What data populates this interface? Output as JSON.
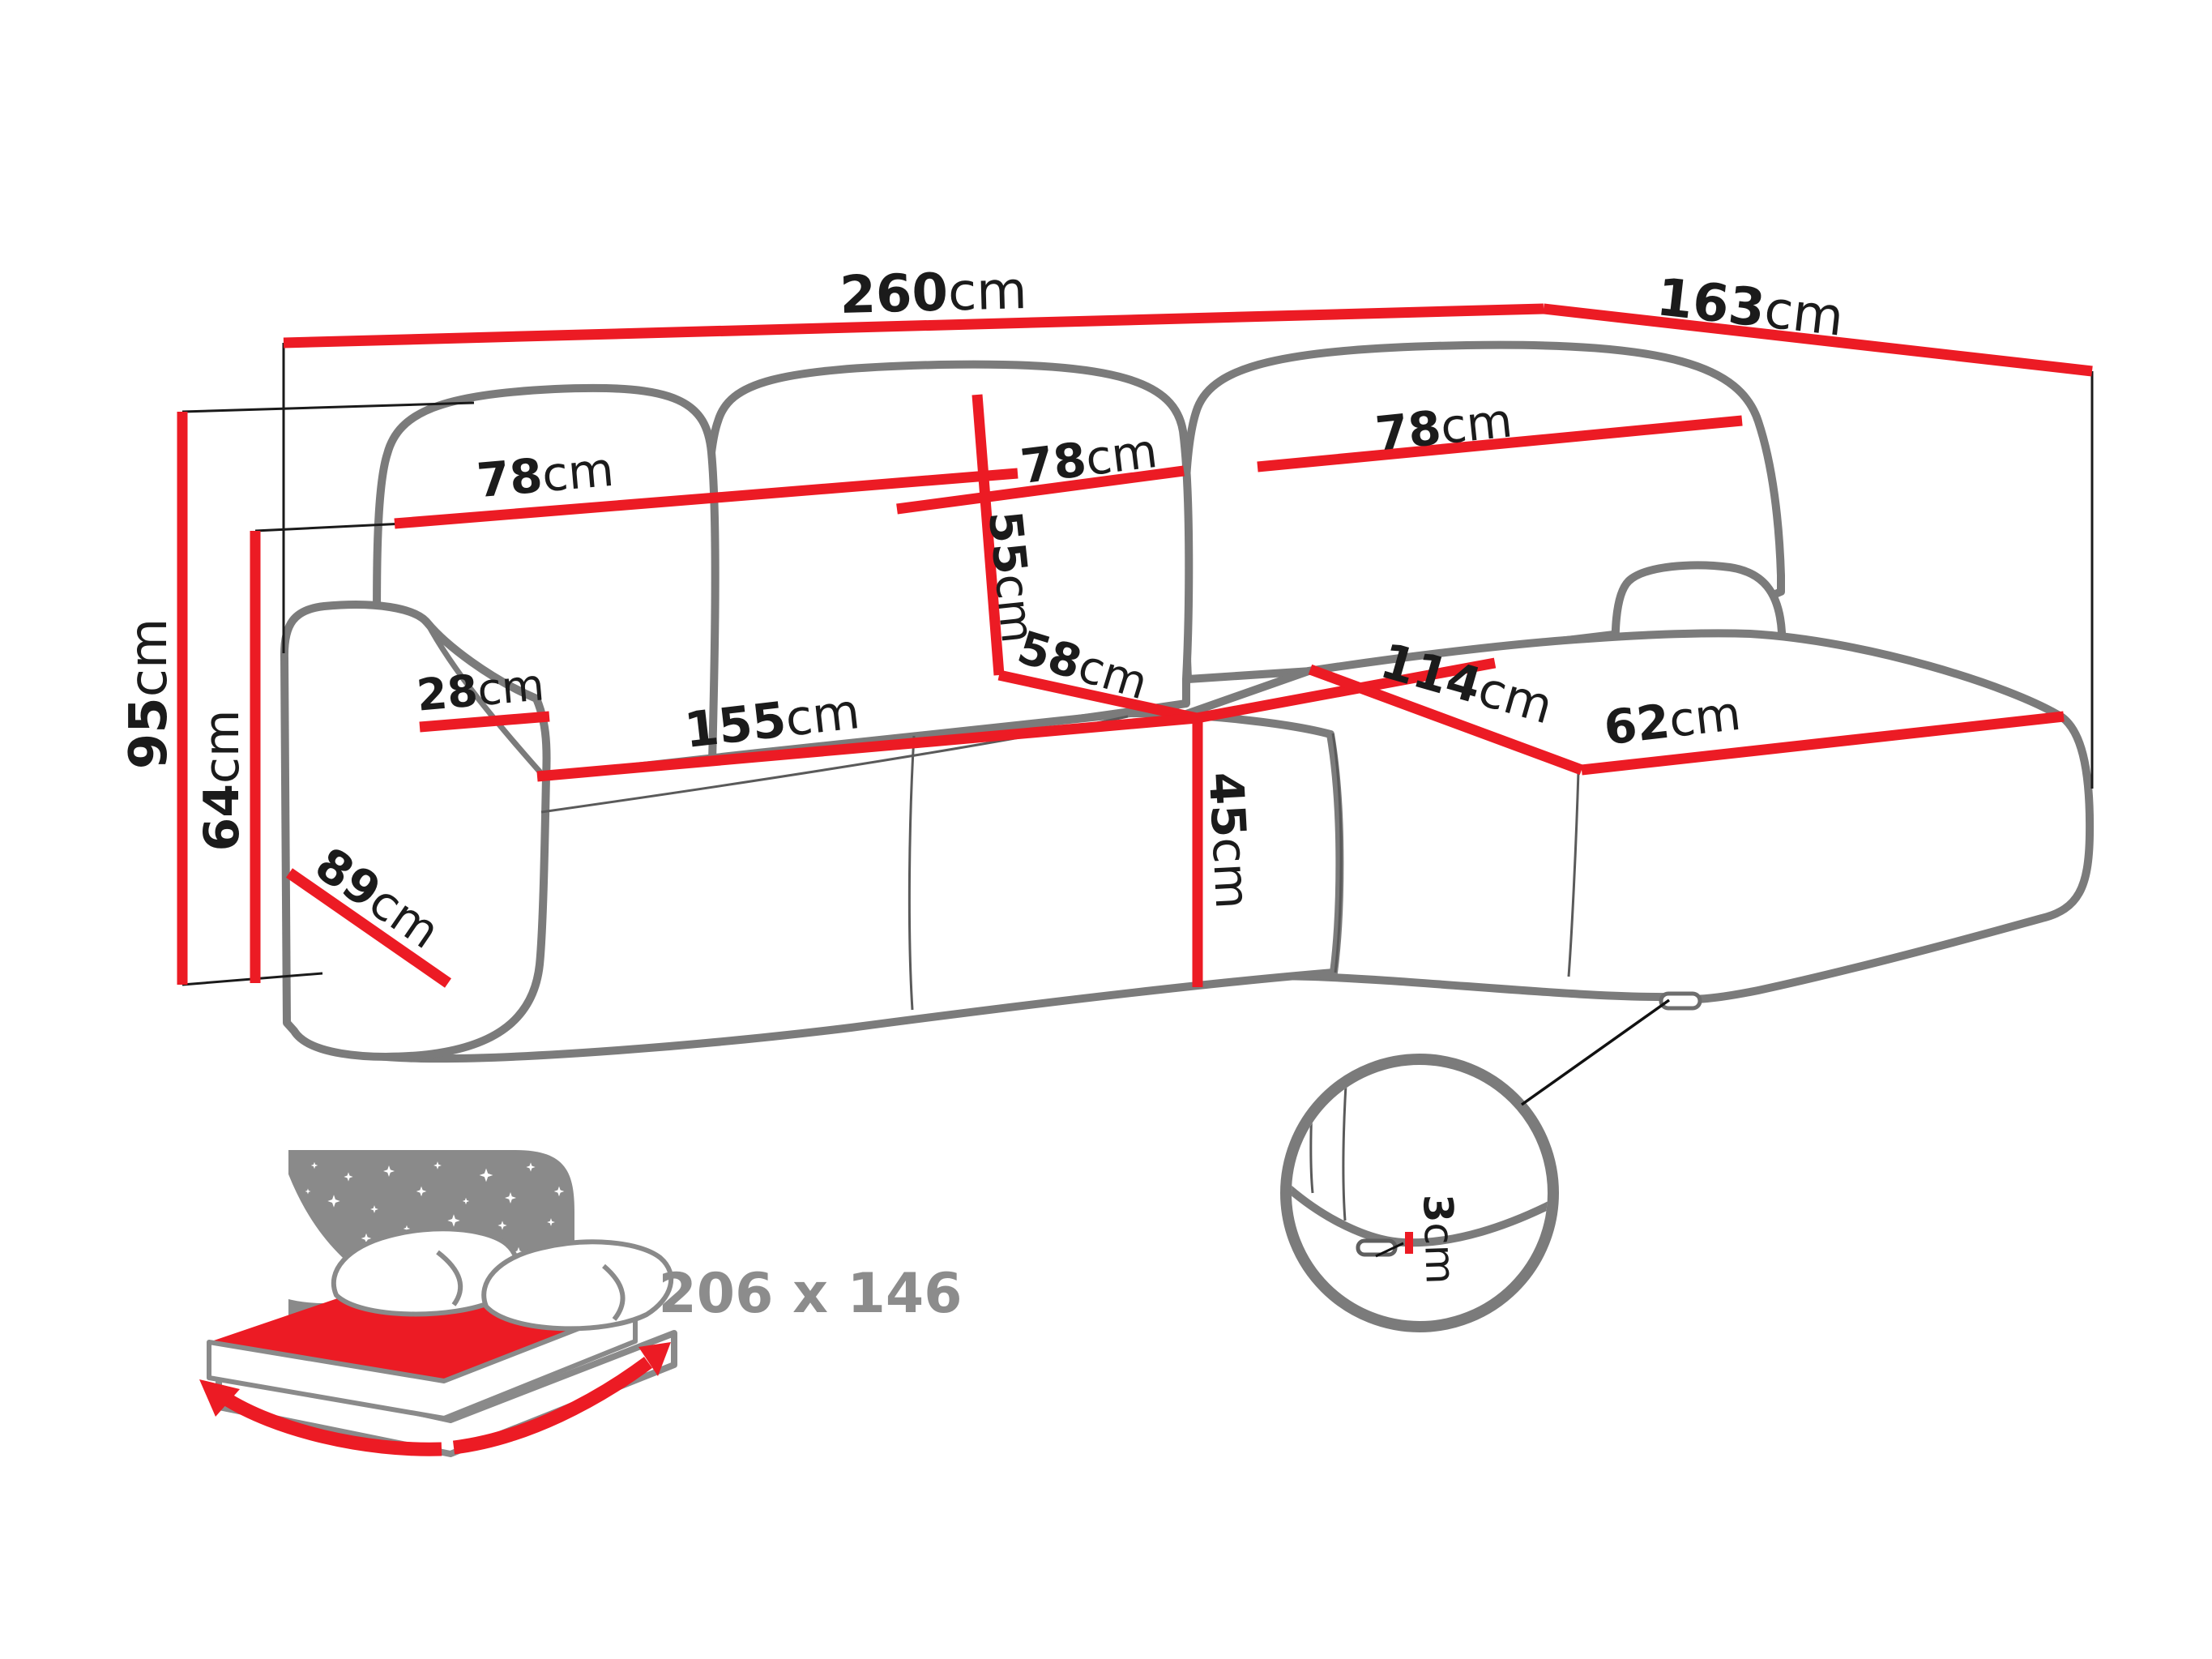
{
  "diagram": {
    "title": "corner-sofa-dimensions",
    "labels": {
      "total_width": {
        "value": "260",
        "unit": "cm"
      },
      "total_depth": {
        "value": "163",
        "unit": "cm"
      },
      "total_height": {
        "value": "95",
        "unit": "cm"
      },
      "armrest_height": {
        "value": "64",
        "unit": "cm"
      },
      "back_cushion_left": {
        "value": "78",
        "unit": "cm"
      },
      "back_cushion_middle": {
        "value": "78",
        "unit": "cm"
      },
      "back_cushion_right": {
        "value": "78",
        "unit": "cm"
      },
      "backrest_height": {
        "value": "55",
        "unit": "cm"
      },
      "seat_depth": {
        "value": "58",
        "unit": "cm"
      },
      "armrest_width": {
        "value": "28",
        "unit": "cm"
      },
      "seat_width": {
        "value": "155",
        "unit": "cm"
      },
      "chaise_length": {
        "value": "114",
        "unit": "cm"
      },
      "chaise_width": {
        "value": "62",
        "unit": "cm"
      },
      "seat_height": {
        "value": "45",
        "unit": "cm"
      },
      "armrest_depth": {
        "value": "89",
        "unit": "cm"
      },
      "leg_height": {
        "value": "3",
        "unit": "cm"
      }
    },
    "sleeping_area": {
      "label": "206 x 146"
    },
    "colors": {
      "dimension_red": "#ec1b24",
      "outline_gray": "#7b7b7b",
      "icon_gray": "#8a8a8a",
      "text_black": "#1b1b1b",
      "sleeping_label_gray": "#8c8c8c"
    }
  }
}
